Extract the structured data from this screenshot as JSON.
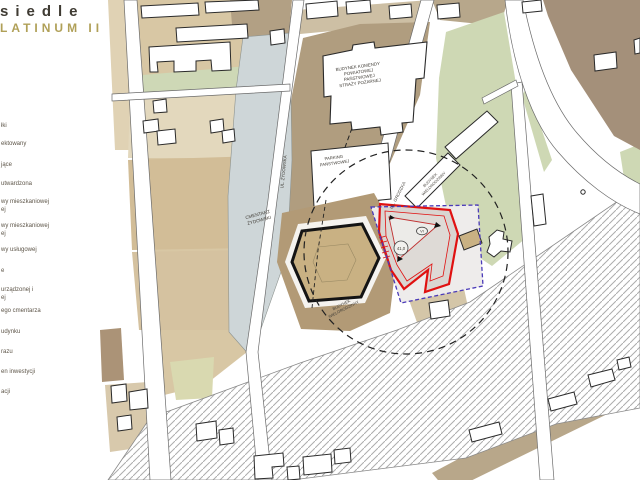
{
  "title": {
    "line1": "siedle",
    "line2": "LATINUM II"
  },
  "legend": {
    "items": [
      "łki",
      "ektowany",
      "jące",
      "utwardzona",
      "wy mieszkaniowej",
      "ej",
      "wy mieszkaniowej",
      "ej",
      "wy usługowej",
      "e",
      "urządzonej i",
      "ej",
      "ego cmentarza",
      "udynku",
      "razu",
      "en inwestycji",
      "acji"
    ]
  },
  "map": {
    "fire_station_label": [
      "BUDYNEK KOMENDY",
      "POWIATOWEJ",
      "PAŃSTWOWEJ",
      "STRAŻY POŻARNEJ"
    ],
    "parking_label": [
      "PARKING",
      "PAŃSTWOWEJ"
    ],
    "cemetery_label": [
      "CMENTARZ",
      "ŻYDOWSKI"
    ],
    "street_zydowska": "UL. ŻYDOWSKA",
    "street_grodzka": "UL. GRODZKA",
    "multifamily_building_label": [
      "BUDYNEK",
      "WIELORODZINNY"
    ],
    "existing_building_label": [
      "BUDYNEK",
      "WIELORODZINNY"
    ],
    "height_marker": "41,0",
    "storeys_marker": "VI"
  },
  "colors": {
    "accent_gold": "#b0a058",
    "project_red": "#e01111",
    "boundary_purple": "#4a3ab8",
    "building_tan": "#c9b183",
    "green_area": "#ced8b4",
    "cemetery_gray": "#ced6d8",
    "brown_area": "#a4907a"
  }
}
